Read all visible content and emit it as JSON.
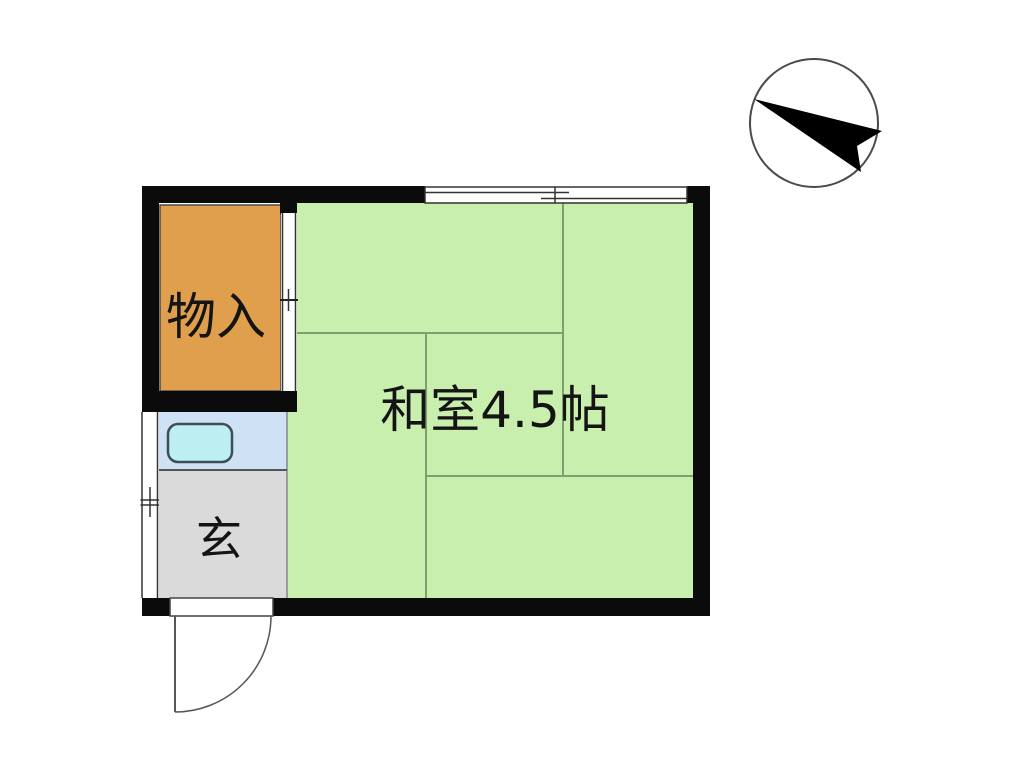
{
  "floorplan": {
    "rooms": {
      "tatami": {
        "label": "和室4.5帖",
        "fill": "#c9efae"
      },
      "storage": {
        "label": "物入",
        "fill": "#df9f4c"
      },
      "entrance": {
        "label": "玄",
        "fill": "#dadada"
      },
      "kitchen": {
        "fill": "#cfe1f4"
      },
      "sink": {
        "fill": "#bceef2",
        "border": "#3d4f56"
      }
    },
    "colors": {
      "wall": "#0b0b0b",
      "tatami_line": "#7f9f70",
      "label_text": "#141414",
      "fixture_line": "#555555",
      "thin_line": "#333333",
      "compass_circle": "#4a4a4a",
      "compass_arrow": "#000000",
      "background": "#ffffff"
    }
  }
}
